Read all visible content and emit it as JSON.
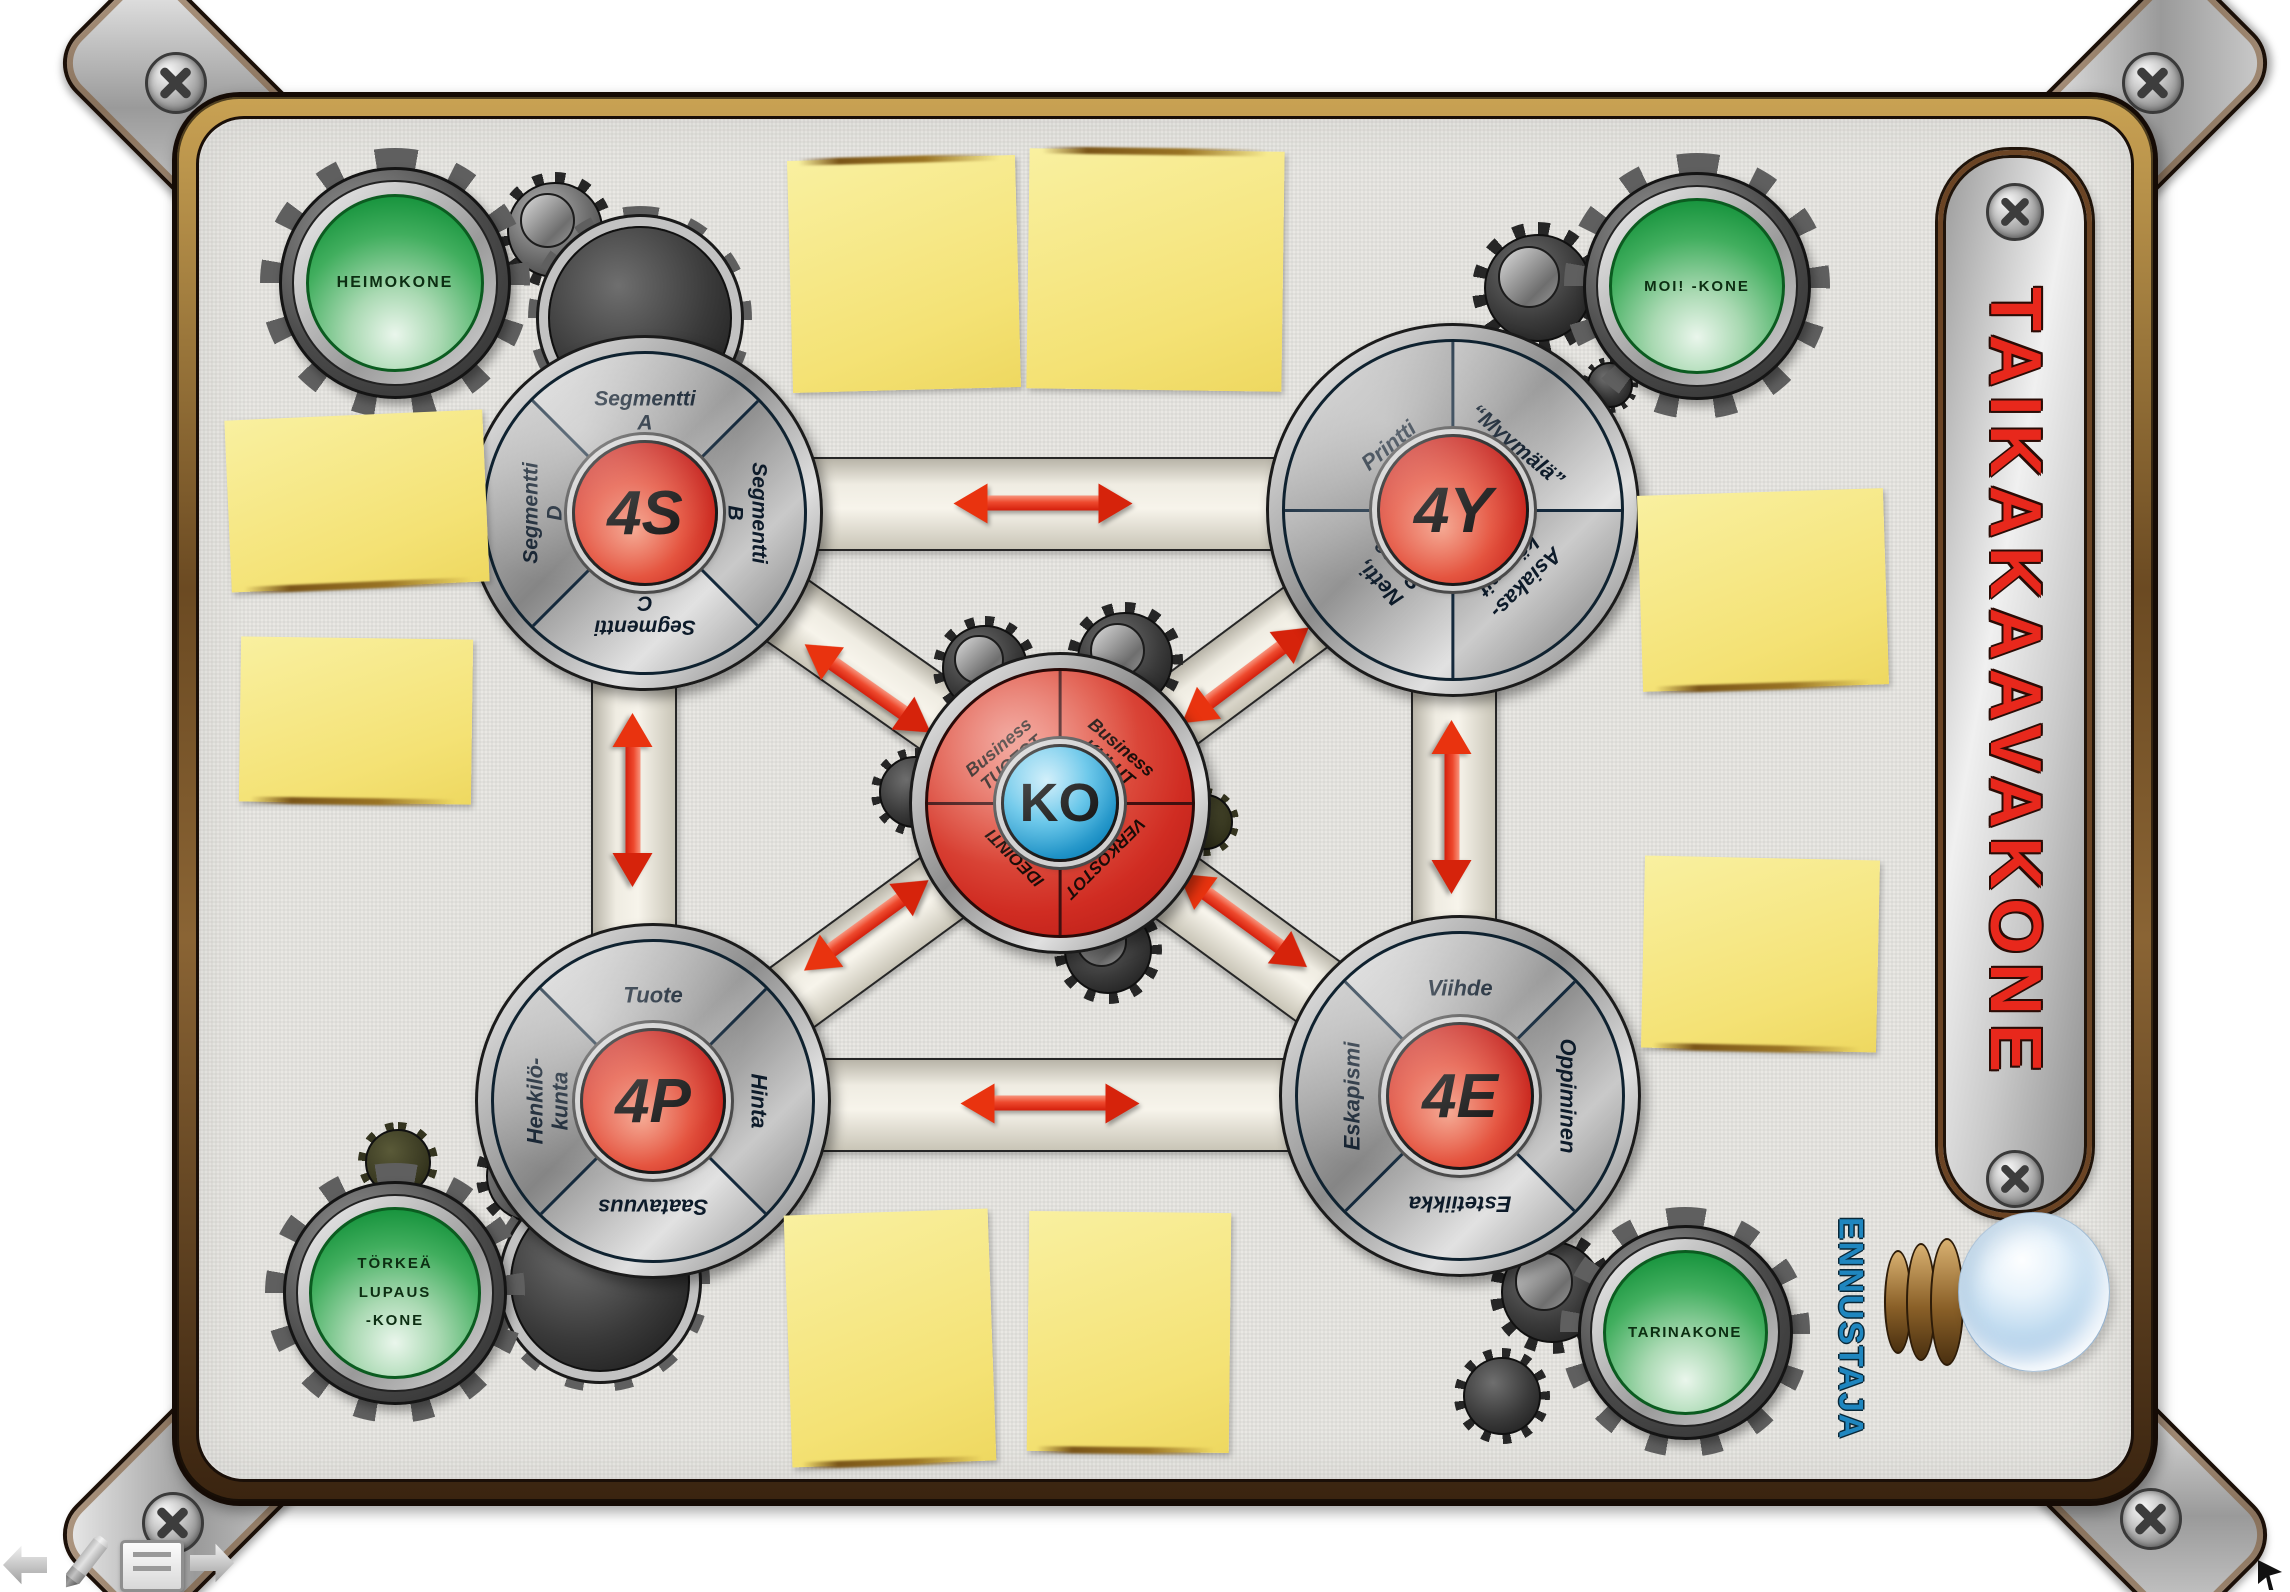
{
  "board": {
    "title": "TAIKAKAAVAKONE",
    "predictor_label": "ENNUSTAJA"
  },
  "wheels": {
    "ko": {
      "hub": "KO",
      "segments": [
        "Business\nTUOTOT",
        "Business\nKULUT",
        "IDEOINTI",
        "VERKOSTOT"
      ]
    },
    "s4": {
      "hub": "4S",
      "segments": [
        "Segmentti\nA",
        "Segmentti\nB",
        "Segmentti\nC",
        "Segmentti\nD"
      ]
    },
    "y4": {
      "hub": "4Y",
      "segments": [
        "Printti",
        "“Myymälä”",
        "Netti,\nSome",
        "Asiakas-\nkäynnit"
      ]
    },
    "p4": {
      "hub": "4P",
      "segments": [
        "Tuote",
        "Hinta",
        "Saatavuus",
        "Henkilö-\nkunta"
      ]
    },
    "e4": {
      "hub": "4E",
      "segments": [
        "Viihde",
        "Oppiminen",
        "Estetiikka",
        "Eskapismi"
      ]
    }
  },
  "machines": {
    "heimokone": "HEIMOKONE",
    "moikone": "MOI! -KONE",
    "torkea": "TÖRKEÄ\nLUPAUS\n-KONE",
    "tarinakone": "TARINAKONE"
  },
  "colors": {
    "wheel_blue": "#1e8fc2",
    "hub_red": "#cc2318",
    "machine_green": "#1d9c42",
    "title_red": "#e8281c",
    "predictor_blue": "#1f86bf",
    "note_yellow": "#f5e87e",
    "arrow_red": "#e62a14",
    "frame_brown": "#6b4424",
    "board_gray": "#e9e8e4"
  }
}
